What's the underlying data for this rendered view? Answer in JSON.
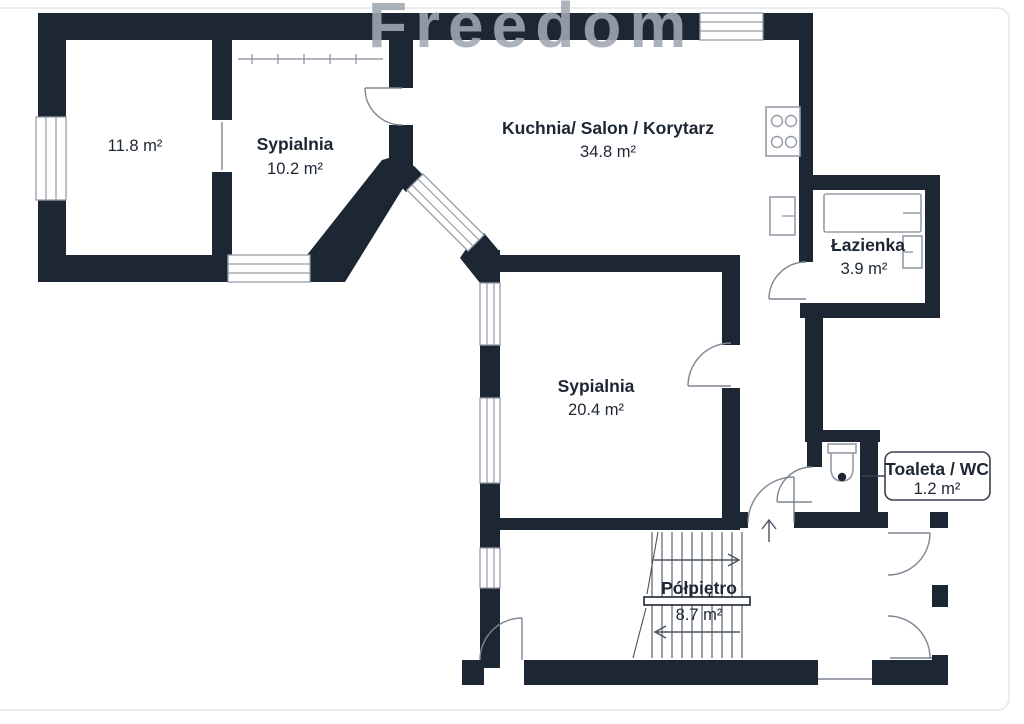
{
  "watermark": "Freedom",
  "rooms": [
    {
      "id": "room-left",
      "name": "",
      "area": "11.8 m²"
    },
    {
      "id": "bedroom-small",
      "name": "Sypialnia",
      "area": "10.2 m²"
    },
    {
      "id": "kitchen",
      "name": "Kuchnia/ Salon / Korytarz",
      "area": "34.8 m²"
    },
    {
      "id": "bathroom",
      "name": "Łazienka",
      "area": "3.9 m²"
    },
    {
      "id": "bedroom-big",
      "name": "Sypialnia",
      "area": "20.4 m²"
    },
    {
      "id": "half-landing",
      "name": "Półpiętro",
      "area": "8.7 m²"
    },
    {
      "id": "toilet",
      "name": "Toaleta / WC",
      "area": "1.2 m²"
    }
  ],
  "icons": [
    "stove-icon",
    "bathtub-icon",
    "sink-icon",
    "kitchen-sink-icon",
    "toilet-icon",
    "stairs-up-arrow-icon",
    "stairs-down-arrow-icon",
    "direction-up-arrow-icon"
  ],
  "colors": {
    "wall": "#1d2633",
    "line": "#49535f",
    "door_arc": "#7d8691",
    "fixture": "#959ca6",
    "watermark": "#a0a8b2",
    "frame": "#e4e6ea",
    "text": "#1d2633"
  }
}
